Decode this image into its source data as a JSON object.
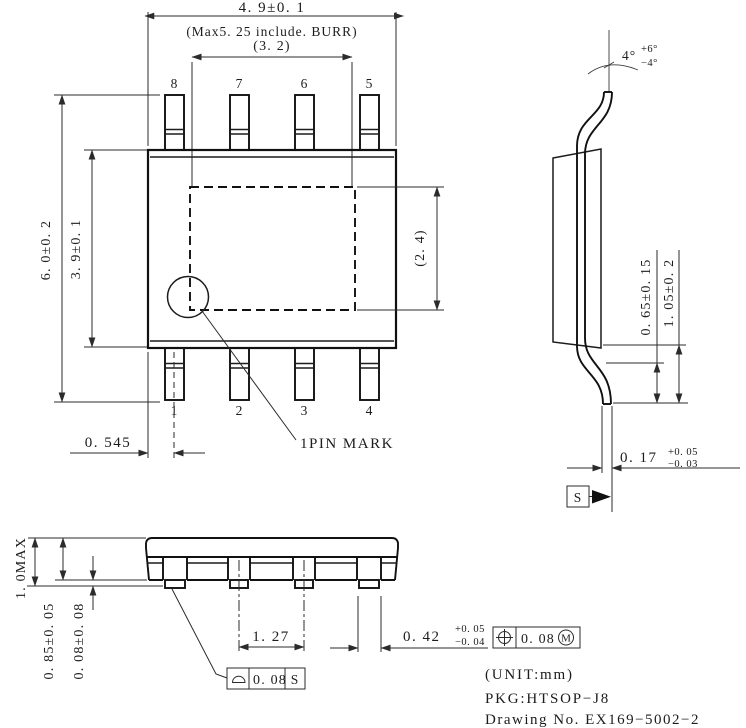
{
  "drawing": {
    "top_view": {
      "dim_body_width": "4. 9±0. 1",
      "dim_width_with_burr": "(Max5. 25 include. BURR)",
      "dim_pad_width": "(3. 2)",
      "dim_pad_height": "(2. 4)",
      "dim_overall_height": "6. 0±0. 2",
      "dim_body_height": "3. 9±0. 1",
      "dim_pin1_offset": "0. 545",
      "pin1_mark_label": "1PIN MARK",
      "pin_numbers_top": [
        "8",
        "7",
        "6",
        "5"
      ],
      "pin_numbers_bottom": [
        "1",
        "2",
        "3",
        "4"
      ]
    },
    "side_view": {
      "lead_angle": "4°",
      "lead_angle_plus": "+6°",
      "lead_angle_minus": "−4°",
      "dim_bend_to_seating": "0. 65±0. 15",
      "dim_body_to_seating": "1. 05±0. 2",
      "dim_lead_thickness": "0. 17",
      "lead_thickness_plus": "+0. 05",
      "lead_thickness_minus": "−0. 03",
      "seating_datum": "S"
    },
    "front_view": {
      "dim_overall_height": "1. 0MAX",
      "dim_body_thickness": "0. 85±0. 05",
      "dim_standoff": "0. 08±0. 08",
      "dim_lead_pitch": "1. 27",
      "dim_lead_width": "0. 42",
      "lead_width_plus": "+0. 05",
      "lead_width_minus": "−0. 04",
      "tolerance_position": "0. 08",
      "tolerance_position_modifier": "M",
      "tolerance_seating": "0. 08",
      "tolerance_seating_datum": "S"
    },
    "notes": {
      "unit": "(UNIT:mm)",
      "package": "PKG:HTSOP−J8",
      "drawing_no": "Drawing No. EX169−5002−2"
    }
  }
}
